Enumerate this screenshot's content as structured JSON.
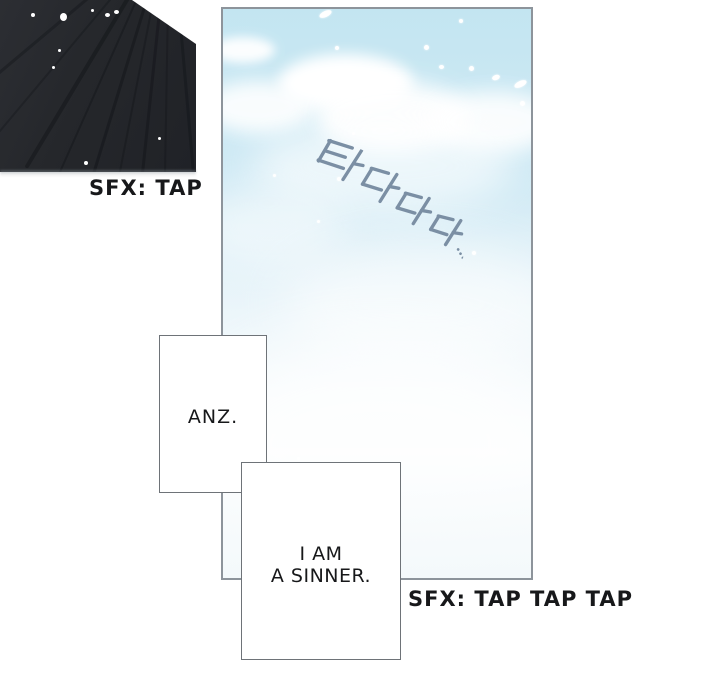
{
  "captions": {
    "top_sfx": "SFX: TAP",
    "bottom_sfx": "SFX: TAP TAP TAP"
  },
  "speech_boxes": {
    "anz": {
      "text": "ANZ."
    },
    "sinner": {
      "line1": "I AM",
      "line2": "A SINNER."
    },
    "fill": "#ffffff",
    "border_color": "#6e7378",
    "text_color": "#17181a"
  },
  "sky_panel": {
    "korean_sfx": "타다다다...",
    "korean_sfx_color": "#7b8fa4",
    "border_color": "#8d949b",
    "sky_top_color": "#c3e5f1",
    "sky_mid_color": "#d9edf6",
    "sky_bottom_color": "#f0f7fa",
    "cloud_color": "#ffffff",
    "clouds": [
      {
        "x": -12,
        "y": 28,
        "w": 64,
        "h": 26,
        "blur": 5,
        "op": 0.95
      },
      {
        "x": -20,
        "y": 72,
        "w": 112,
        "h": 52,
        "blur": 9,
        "op": 0.9
      },
      {
        "x": 55,
        "y": 45,
        "w": 135,
        "h": 58,
        "blur": 7,
        "op": 1
      },
      {
        "x": 92,
        "y": 72,
        "w": 155,
        "h": 72,
        "blur": 10,
        "op": 0.95
      },
      {
        "x": 205,
        "y": 82,
        "w": 130,
        "h": 62,
        "blur": 10,
        "op": 0.9
      },
      {
        "x": 30,
        "y": 112,
        "w": 260,
        "h": 90,
        "blur": 18,
        "op": 0.6
      },
      {
        "x": -30,
        "y": 178,
        "w": 150,
        "h": 78,
        "blur": 20,
        "op": 0.5
      },
      {
        "x": 60,
        "y": 235,
        "w": 280,
        "h": 120,
        "blur": 24,
        "op": 0.55
      },
      {
        "x": -25,
        "y": 330,
        "w": 365,
        "h": 210,
        "blur": 30,
        "op": 0.7
      }
    ],
    "snow": [
      {
        "x": 96,
        "y": 2,
        "w": 13,
        "h": 6,
        "rot": -25
      },
      {
        "x": 112,
        "y": 37,
        "w": 4,
        "h": 4,
        "rot": 0
      },
      {
        "x": 201,
        "y": 36,
        "w": 5,
        "h": 5,
        "rot": 0
      },
      {
        "x": 236,
        "y": 10,
        "w": 4,
        "h": 4,
        "rot": 0
      },
      {
        "x": 216,
        "y": 56,
        "w": 5,
        "h": 4,
        "rot": 0
      },
      {
        "x": 246,
        "y": 57,
        "w": 5,
        "h": 5,
        "rot": 0
      },
      {
        "x": 269,
        "y": 66,
        "w": 8,
        "h": 5,
        "rot": -20
      },
      {
        "x": 291,
        "y": 72,
        "w": 13,
        "h": 6,
        "rot": -25
      },
      {
        "x": 297,
        "y": 92,
        "w": 5,
        "h": 5,
        "rot": 0
      },
      {
        "x": 129,
        "y": 123,
        "w": 3,
        "h": 3,
        "rot": 0
      },
      {
        "x": 114,
        "y": 168,
        "w": 4,
        "h": 4,
        "rot": 0
      },
      {
        "x": 50,
        "y": 165,
        "w": 3,
        "h": 3,
        "rot": 0
      },
      {
        "x": 94,
        "y": 211,
        "w": 3,
        "h": 3,
        "rot": 0
      },
      {
        "x": 249,
        "y": 242,
        "w": 4,
        "h": 4,
        "rot": 0
      },
      {
        "x": 74,
        "y": 448,
        "w": 3,
        "h": 3,
        "rot": 0
      }
    ]
  },
  "dark_panel": {
    "base_color_light": "#2c2e33",
    "base_color_dark": "#202227",
    "streak_color": "rgba(9,11,15,0.55)",
    "speck_color": "#ffffff",
    "streaks": [
      {
        "left": 150,
        "rot": 50,
        "w": 3,
        "op": 0.5
      },
      {
        "left": 155,
        "rot": 40,
        "w": 2,
        "op": 0.45
      },
      {
        "left": 158,
        "rot": 31,
        "w": 4,
        "op": 0.6
      },
      {
        "left": 160,
        "rot": 24,
        "w": 2,
        "op": 0.5
      },
      {
        "left": 162,
        "rot": 17,
        "w": 3,
        "op": 0.6
      },
      {
        "left": 163,
        "rot": 11,
        "w": 2,
        "op": 0.45
      },
      {
        "left": 165,
        "rot": 6,
        "w": 3,
        "op": 0.55
      },
      {
        "left": 168,
        "rot": 1,
        "w": 2,
        "op": 0.4
      },
      {
        "left": 172,
        "rot": -5,
        "w": 3,
        "op": 0.5
      }
    ],
    "specks": [
      {
        "x": 31,
        "y": 13,
        "w": 4,
        "h": 4
      },
      {
        "x": 60,
        "y": 13,
        "w": 7,
        "h": 8
      },
      {
        "x": 91,
        "y": 9,
        "w": 3,
        "h": 3
      },
      {
        "x": 105,
        "y": 13,
        "w": 5,
        "h": 4
      },
      {
        "x": 114,
        "y": 10,
        "w": 5,
        "h": 4
      },
      {
        "x": 58,
        "y": 49,
        "w": 3,
        "h": 3
      },
      {
        "x": 52,
        "y": 66,
        "w": 3,
        "h": 3
      },
      {
        "x": 84,
        "y": 161,
        "w": 4,
        "h": 4
      },
      {
        "x": 158,
        "y": 137,
        "w": 3,
        "h": 3
      }
    ]
  }
}
